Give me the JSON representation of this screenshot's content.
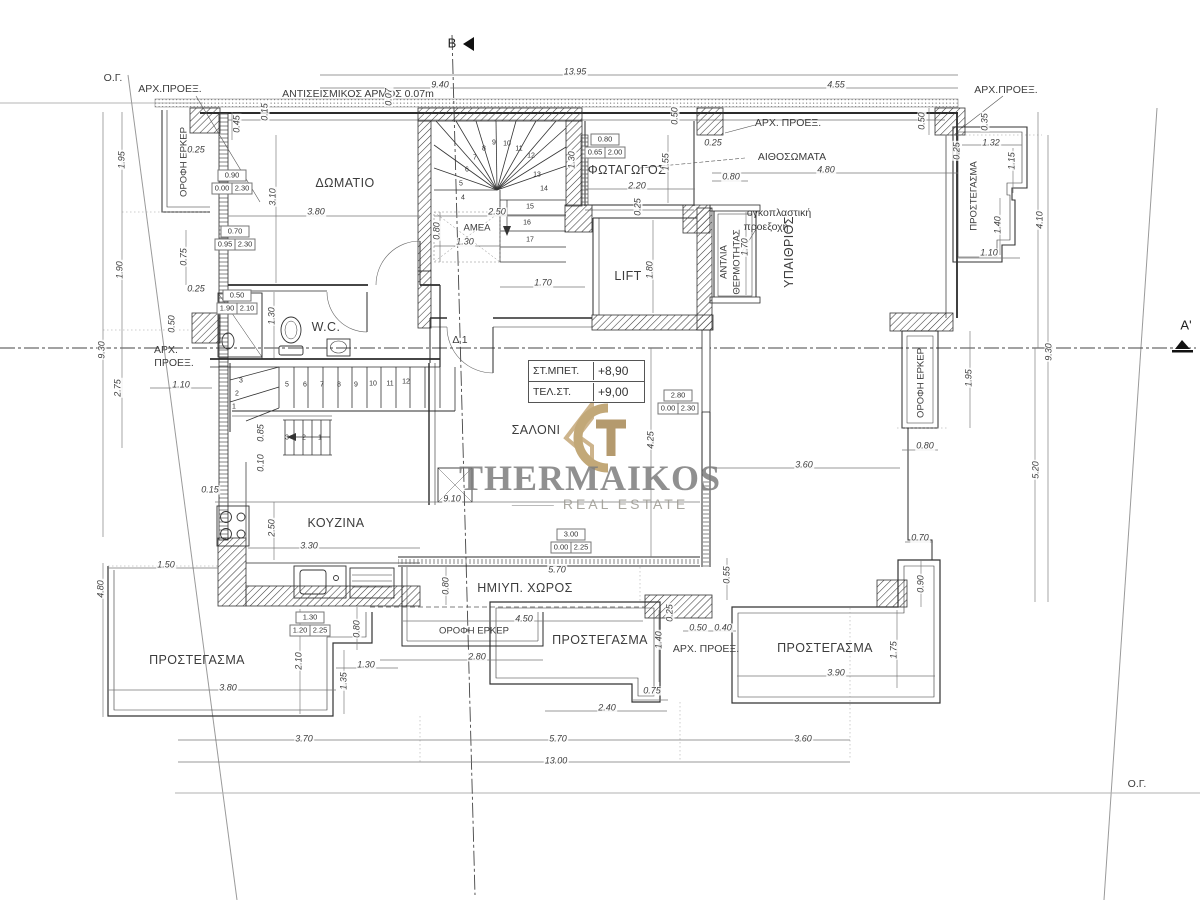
{
  "watermark": {
    "name": "THERMAIKOS",
    "tagline": "REAL ESTATE"
  },
  "levels": [
    {
      "label": "ΣΤ.ΜΠΕΤ.",
      "value": "+8,90"
    },
    {
      "label": "ΤΕΛ.ΣΤ.",
      "value": "+9,00"
    }
  ],
  "tags": [
    {
      "w": "0.90",
      "a": "0.00",
      "b": "2.30",
      "x": 232,
      "y": 182
    },
    {
      "w": "0.70",
      "a": "0.95",
      "b": "2.30",
      "x": 235,
      "y": 238
    },
    {
      "w": "0.50",
      "a": "1.90",
      "b": "2.10",
      "x": 237,
      "y": 302
    },
    {
      "w": "0.80",
      "a": "0.65",
      "b": "2.00",
      "x": 605,
      "y": 146
    },
    {
      "w": "2.80",
      "a": "0.00",
      "b": "2.30",
      "x": 678,
      "y": 402
    },
    {
      "w": "3.00",
      "a": "0.00",
      "b": "2.25",
      "x": 571,
      "y": 541
    },
    {
      "w": "1.30",
      "a": "1.20",
      "b": "2.25",
      "x": 310,
      "y": 624
    }
  ],
  "labels": [
    {
      "t": "ΔΩΜΑΤΙΟ",
      "x": 345,
      "y": 183,
      "c": "room",
      "n": "room-label-bedroom"
    },
    {
      "t": "ΦΩΤΑΓΩΓΟΣ",
      "x": 627,
      "y": 170,
      "c": "room",
      "n": "room-label-lightwell"
    },
    {
      "t": "LIFT",
      "x": 628,
      "y": 276,
      "c": "room",
      "n": "room-label-lift"
    },
    {
      "t": "ΑΜΕΑ",
      "x": 477,
      "y": 228,
      "c": "sr",
      "n": "room-label-amea"
    },
    {
      "t": "W.C.",
      "x": 326,
      "y": 327,
      "c": "room",
      "n": "room-label-wc"
    },
    {
      "t": "ΣΑΛΟΝΙ",
      "x": 536,
      "y": 430,
      "c": "room",
      "n": "room-label-livingroom"
    },
    {
      "t": "ΚΟΥΖΙΝΑ",
      "x": 336,
      "y": 523,
      "c": "room",
      "n": "room-label-kitchen"
    },
    {
      "t": "ΥΠΑΙΘΡΙΟΣ",
      "x": 789,
      "y": 252,
      "c": "room",
      "r": 1,
      "n": "room-label-openair"
    },
    {
      "t": "ΗΜΙΥΠ. ΧΩΡΟΣ",
      "x": 525,
      "y": 588,
      "c": "room",
      "n": "room-label-semiopen"
    },
    {
      "t": "ΠΡΟΣΤΕΓΑΣΜΑ",
      "x": 197,
      "y": 660,
      "c": "room",
      "n": "room-label-canopy-sw"
    },
    {
      "t": "ΠΡΟΣΤΕΓΑΣΜΑ",
      "x": 600,
      "y": 640,
      "c": "room",
      "n": "room-label-canopy-s"
    },
    {
      "t": "ΠΡΟΣΤΕΓΑΣΜΑ",
      "x": 825,
      "y": 648,
      "c": "room",
      "n": "room-label-canopy-se"
    },
    {
      "t": "ΠΡΟΣΤΕΓΑΣΜΑ",
      "x": 974,
      "y": 196,
      "c": "sr",
      "r": 1,
      "n": "room-label-canopy-ne"
    },
    {
      "t": "ΟΡΟΦΗ ΕΡΚΕΡ",
      "x": 184,
      "y": 162,
      "c": "sr",
      "r": 1,
      "n": "label-bay-roof-w"
    },
    {
      "t": "ΟΡΟΦΗ ΕΡΚΕΡ",
      "x": 921,
      "y": 383,
      "c": "sr",
      "r": 1,
      "n": "label-bay-roof-e"
    },
    {
      "t": "ΟΡΟΦΗ ΕΡΚΕΡ",
      "x": 474,
      "y": 631,
      "c": "sr",
      "n": "label-bay-roof-s"
    },
    {
      "t": "ΑΝΤΛΙΑ",
      "x": 724,
      "y": 262,
      "c": "sr",
      "r": 1,
      "n": "label-heatpump-1"
    },
    {
      "t": "ΘΕΡΜΟΤΗΤΑΣ",
      "x": 737,
      "y": 262,
      "c": "sr",
      "r": 1,
      "n": "label-heatpump-2"
    },
    {
      "t": "Ο.Γ.",
      "x": 113,
      "y": 78,
      "c": "note",
      "n": "note-og-topleft"
    },
    {
      "t": "Ο.Γ.",
      "x": 1137,
      "y": 784,
      "c": "note",
      "n": "note-og-bottomright"
    },
    {
      "t": "ΑΡΧ.ΠΡΟΕΞ.",
      "x": 170,
      "y": 89,
      "c": "note",
      "n": "note-arch-proj-1"
    },
    {
      "t": "ΑΡΧ.ΠΡΟΕΞ.",
      "x": 1006,
      "y": 90,
      "c": "note",
      "n": "note-arch-proj-2"
    },
    {
      "t": "ΑΡΧ. ΠΡΟΕΞ.",
      "x": 788,
      "y": 123,
      "c": "note",
      "n": "note-arch-proj-3"
    },
    {
      "t": "ΑΡΧ.",
      "x": 166,
      "y": 350,
      "c": "note",
      "n": "note-arch-proj-4a"
    },
    {
      "t": "ΠΡΟΕΞ.",
      "x": 174,
      "y": 363,
      "c": "note",
      "n": "note-arch-proj-4b"
    },
    {
      "t": "ΑΡΧ. ΠΡΟΕΞ.",
      "x": 706,
      "y": 649,
      "c": "note",
      "n": "note-arch-proj-5"
    },
    {
      "t": "ΑΙΘΟΣΩΜΑΤΑ",
      "x": 792,
      "y": 157,
      "c": "note",
      "n": "note-radiators"
    },
    {
      "t": "ΑΝΤΙΣΕΙΣΜΙΚΟΣ ΑΡΜΟΣ 0.07m",
      "x": 358,
      "y": 94,
      "c": "note",
      "n": "note-seismic-joint"
    },
    {
      "t": "ογκοπλαστική",
      "x": 779,
      "y": 213,
      "c": "note",
      "n": "note-volume-proj-1"
    },
    {
      "t": "προεξοχή",
      "x": 766,
      "y": 227,
      "c": "note",
      "n": "note-volume-proj-2"
    },
    {
      "t": "Δ 1",
      "x": 460,
      "y": 340,
      "c": "note",
      "n": "note-door-d1"
    },
    {
      "t": "Β",
      "x": 452,
      "y": 43,
      "c": "big",
      "n": "section-marker-b"
    },
    {
      "t": "Α'",
      "x": 1186,
      "y": 325,
      "c": "big",
      "n": "section-marker-a"
    },
    {
      "t": "13.95",
      "x": 575,
      "y": 72,
      "c": "dim"
    },
    {
      "t": "9.40",
      "x": 440,
      "y": 85,
      "c": "dim"
    },
    {
      "t": "4.55",
      "x": 836,
      "y": 85,
      "c": "dim"
    },
    {
      "t": "0.07",
      "x": 389,
      "y": 97,
      "c": "dim",
      "r": 1
    },
    {
      "t": "0.45",
      "x": 237,
      "y": 124,
      "c": "dim",
      "r": 1
    },
    {
      "t": "0.15",
      "x": 265,
      "y": 112,
      "c": "dim",
      "r": 1
    },
    {
      "t": "1.95",
      "x": 122,
      "y": 160,
      "c": "dim",
      "r": 1
    },
    {
      "t": "1.90",
      "x": 120,
      "y": 270,
      "c": "dim",
      "r": 1
    },
    {
      "t": "2.75",
      "x": 118,
      "y": 388,
      "c": "dim",
      "r": 1
    },
    {
      "t": "9.30",
      "x": 102,
      "y": 350,
      "c": "dim",
      "r": 1
    },
    {
      "t": "0.75",
      "x": 184,
      "y": 257,
      "c": "dim",
      "r": 1
    },
    {
      "t": "0.25",
      "x": 196,
      "y": 289,
      "c": "dim"
    },
    {
      "t": "0.50",
      "x": 172,
      "y": 324,
      "c": "dim",
      "r": 1
    },
    {
      "t": "1.10",
      "x": 181,
      "y": 385,
      "c": "dim"
    },
    {
      "t": "0.25",
      "x": 196,
      "y": 150,
      "c": "dim"
    },
    {
      "t": "3.10",
      "x": 273,
      "y": 197,
      "c": "dim",
      "r": 1
    },
    {
      "t": "3.80",
      "x": 316,
      "y": 212,
      "c": "dim"
    },
    {
      "t": "2.50",
      "x": 497,
      "y": 212,
      "c": "dim"
    },
    {
      "t": "0.80",
      "x": 437,
      "y": 231,
      "c": "dim",
      "r": 1
    },
    {
      "t": "1.30",
      "x": 465,
      "y": 242,
      "c": "dim"
    },
    {
      "t": "1.70",
      "x": 543,
      "y": 283,
      "c": "dim"
    },
    {
      "t": "1.80",
      "x": 650,
      "y": 270,
      "c": "dim",
      "r": 1
    },
    {
      "t": "0.25",
      "x": 638,
      "y": 207,
      "c": "dim",
      "r": 1
    },
    {
      "t": "1.30",
      "x": 572,
      "y": 160,
      "c": "dim",
      "r": 1
    },
    {
      "t": "1.55",
      "x": 666,
      "y": 162,
      "c": "dim",
      "r": 1
    },
    {
      "t": "0.50",
      "x": 675,
      "y": 116,
      "c": "dim",
      "r": 1
    },
    {
      "t": "2.20",
      "x": 637,
      "y": 186,
      "c": "dim"
    },
    {
      "t": "0.25",
      "x": 713,
      "y": 143,
      "c": "dim"
    },
    {
      "t": "0.80",
      "x": 731,
      "y": 177,
      "c": "dim"
    },
    {
      "t": "4.80",
      "x": 826,
      "y": 170,
      "c": "dim"
    },
    {
      "t": "0.50",
      "x": 922,
      "y": 121,
      "c": "dim",
      "r": 1
    },
    {
      "t": "1.70",
      "x": 745,
      "y": 247,
      "c": "dim",
      "r": 1
    },
    {
      "t": "0.35",
      "x": 985,
      "y": 122,
      "c": "dim",
      "r": 1
    },
    {
      "t": "1.32",
      "x": 991,
      "y": 143,
      "c": "dim"
    },
    {
      "t": "0.25",
      "x": 957,
      "y": 151,
      "c": "dim",
      "r": 1
    },
    {
      "t": "1.15",
      "x": 1012,
      "y": 161,
      "c": "dim",
      "r": 1
    },
    {
      "t": "1.40",
      "x": 998,
      "y": 225,
      "c": "dim",
      "r": 1
    },
    {
      "t": "1.10",
      "x": 989,
      "y": 253,
      "c": "dim"
    },
    {
      "t": "4.10",
      "x": 1040,
      "y": 220,
      "c": "dim",
      "r": 1
    },
    {
      "t": "1.95",
      "x": 969,
      "y": 378,
      "c": "dim",
      "r": 1
    },
    {
      "t": "9.30",
      "x": 1049,
      "y": 352,
      "c": "dim",
      "r": 1
    },
    {
      "t": "5.20",
      "x": 1036,
      "y": 470,
      "c": "dim",
      "r": 1
    },
    {
      "t": "0.80",
      "x": 925,
      "y": 446,
      "c": "dim"
    },
    {
      "t": "3.60",
      "x": 804,
      "y": 465,
      "c": "dim"
    },
    {
      "t": "0.70",
      "x": 920,
      "y": 538,
      "c": "dim"
    },
    {
      "t": "0.90",
      "x": 921,
      "y": 584,
      "c": "dim",
      "r": 1
    },
    {
      "t": "1.75",
      "x": 894,
      "y": 650,
      "c": "dim",
      "r": 1
    },
    {
      "t": "3.90",
      "x": 836,
      "y": 673,
      "c": "dim"
    },
    {
      "t": "1.30",
      "x": 272,
      "y": 316,
      "c": "dim",
      "r": 1
    },
    {
      "t": "0.85",
      "x": 261,
      "y": 433,
      "c": "dim",
      "r": 1
    },
    {
      "t": "0.10",
      "x": 261,
      "y": 463,
      "c": "dim",
      "r": 1
    },
    {
      "t": "0.15",
      "x": 210,
      "y": 490,
      "c": "dim"
    },
    {
      "t": "2.50",
      "x": 272,
      "y": 528,
      "c": "dim",
      "r": 1
    },
    {
      "t": "9.10",
      "x": 452,
      "y": 499,
      "c": "dim"
    },
    {
      "t": "3.30",
      "x": 309,
      "y": 546,
      "c": "dim"
    },
    {
      "t": "1.50",
      "x": 166,
      "y": 565,
      "c": "dim"
    },
    {
      "t": "4.80",
      "x": 101,
      "y": 589,
      "c": "dim",
      "r": 1
    },
    {
      "t": "5.70",
      "x": 557,
      "y": 570,
      "c": "dim"
    },
    {
      "t": "0.80",
      "x": 446,
      "y": 586,
      "c": "dim",
      "r": 1
    },
    {
      "t": "4.50",
      "x": 524,
      "y": 619,
      "c": "dim"
    },
    {
      "t": "2.80",
      "x": 477,
      "y": 657,
      "c": "dim"
    },
    {
      "t": "1.40",
      "x": 659,
      "y": 640,
      "c": "dim",
      "r": 1
    },
    {
      "t": "0.25",
      "x": 670,
      "y": 613,
      "c": "dim",
      "r": 1
    },
    {
      "t": "0.75",
      "x": 652,
      "y": 691,
      "c": "dim"
    },
    {
      "t": "2.40",
      "x": 607,
      "y": 708,
      "c": "dim"
    },
    {
      "t": "0.50",
      "x": 698,
      "y": 628,
      "c": "dim"
    },
    {
      "t": "0.40",
      "x": 723,
      "y": 628,
      "c": "dim"
    },
    {
      "t": "0.55",
      "x": 727,
      "y": 575,
      "c": "dim",
      "r": 1
    },
    {
      "t": "0.80",
      "x": 357,
      "y": 629,
      "c": "dim",
      "r": 1
    },
    {
      "t": "2.10",
      "x": 299,
      "y": 661,
      "c": "dim",
      "r": 1
    },
    {
      "t": "1.35",
      "x": 344,
      "y": 681,
      "c": "dim",
      "r": 1
    },
    {
      "t": "1.30",
      "x": 366,
      "y": 665,
      "c": "dim"
    },
    {
      "t": "3.80",
      "x": 228,
      "y": 688,
      "c": "dim"
    },
    {
      "t": "3.70",
      "x": 304,
      "y": 739,
      "c": "dim"
    },
    {
      "t": "5.70",
      "x": 558,
      "y": 739,
      "c": "dim"
    },
    {
      "t": "3.60",
      "x": 803,
      "y": 739,
      "c": "dim"
    },
    {
      "t": "13.00",
      "x": 556,
      "y": 761,
      "c": "dim"
    },
    {
      "t": "4.25",
      "x": 651,
      "y": 440,
      "c": "dim",
      "r": 1
    },
    {
      "t": "4",
      "x": 463,
      "y": 198,
      "c": "sn"
    },
    {
      "t": "5",
      "x": 461,
      "y": 184,
      "c": "sn"
    },
    {
      "t": "6",
      "x": 467,
      "y": 170,
      "c": "sn"
    },
    {
      "t": "7",
      "x": 475,
      "y": 158,
      "c": "sn"
    },
    {
      "t": "8",
      "x": 484,
      "y": 149,
      "c": "sn"
    },
    {
      "t": "9",
      "x": 494,
      "y": 143,
      "c": "sn"
    },
    {
      "t": "10",
      "x": 507,
      "y": 144,
      "c": "sn"
    },
    {
      "t": "11",
      "x": 519,
      "y": 149,
      "c": "sn"
    },
    {
      "t": "12",
      "x": 531,
      "y": 156,
      "c": "sn"
    },
    {
      "t": "13",
      "x": 537,
      "y": 175,
      "c": "sn"
    },
    {
      "t": "14",
      "x": 544,
      "y": 189,
      "c": "sn"
    },
    {
      "t": "15",
      "x": 530,
      "y": 207,
      "c": "sn"
    },
    {
      "t": "16",
      "x": 527,
      "y": 223,
      "c": "sn"
    },
    {
      "t": "17",
      "x": 530,
      "y": 240,
      "c": "sn"
    },
    {
      "t": "5",
      "x": 287,
      "y": 385,
      "c": "sn"
    },
    {
      "t": "6",
      "x": 305,
      "y": 385,
      "c": "sn"
    },
    {
      "t": "7",
      "x": 322,
      "y": 385,
      "c": "sn"
    },
    {
      "t": "8",
      "x": 339,
      "y": 385,
      "c": "sn"
    },
    {
      "t": "9",
      "x": 356,
      "y": 385,
      "c": "sn"
    },
    {
      "t": "10",
      "x": 373,
      "y": 384,
      "c": "sn"
    },
    {
      "t": "11",
      "x": 390,
      "y": 384,
      "c": "sn"
    },
    {
      "t": "12",
      "x": 406,
      "y": 382,
      "c": "sn"
    },
    {
      "t": "3",
      "x": 241,
      "y": 381,
      "c": "sn"
    },
    {
      "t": "2",
      "x": 237,
      "y": 394,
      "c": "sn"
    },
    {
      "t": "1",
      "x": 234,
      "y": 407,
      "c": "sn"
    },
    {
      "t": "3",
      "x": 287,
      "y": 438,
      "c": "sn"
    },
    {
      "t": "2",
      "x": 304,
      "y": 438,
      "c": "sn"
    },
    {
      "t": "1",
      "x": 320,
      "y": 438,
      "c": "sn"
    }
  ]
}
